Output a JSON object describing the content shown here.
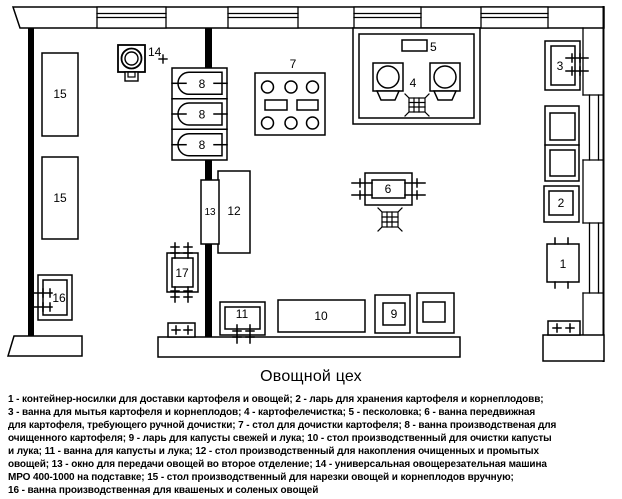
{
  "title": "Овощной цех",
  "legend": "1 - контейнер-носилки для доставки картофеля и овощей; 2 - ларь для хранения картофеля и корнеплодовв;\n3 - ванна для мытья картофеля и корнеплодов; 4 - картофелечистка; 5 - песколовка; 6 - ванна передвижная\nдля картофеля, требующего ручной дочистки; 7 - стол для дочистки картофеля; 8 - ванна производственая для\nочищенного картофеля; 9 - ларь для капусты свежей и лука; 10 - стол производственный для очистки капусты\nи лука; 11 - ванна для капусты и лука; 12 - стол производственный для накопления очищенных и промытых\nовощей; 13 - окно для передачи овощей во второе отделение; 14 - универсальная овощерезательная машина\nМРО 400-1000 на подставке; 15 - стол производственный для нарезки овощей и корнеплодов вручную;\n16 - ванна производственная для квашеных и соленых овощей",
  "colors": {
    "ink": "#000000",
    "paper": "#ffffff"
  },
  "plan": {
    "labels": {
      "1": "1",
      "2": "2",
      "3": "3",
      "4": "4",
      "5": "5",
      "6": "6",
      "7": "7",
      "8": "8",
      "9": "9",
      "10": "10",
      "11": "11",
      "12": "12",
      "13": "13",
      "14": "14",
      "15": "15",
      "16": "16",
      "17": "17"
    }
  }
}
